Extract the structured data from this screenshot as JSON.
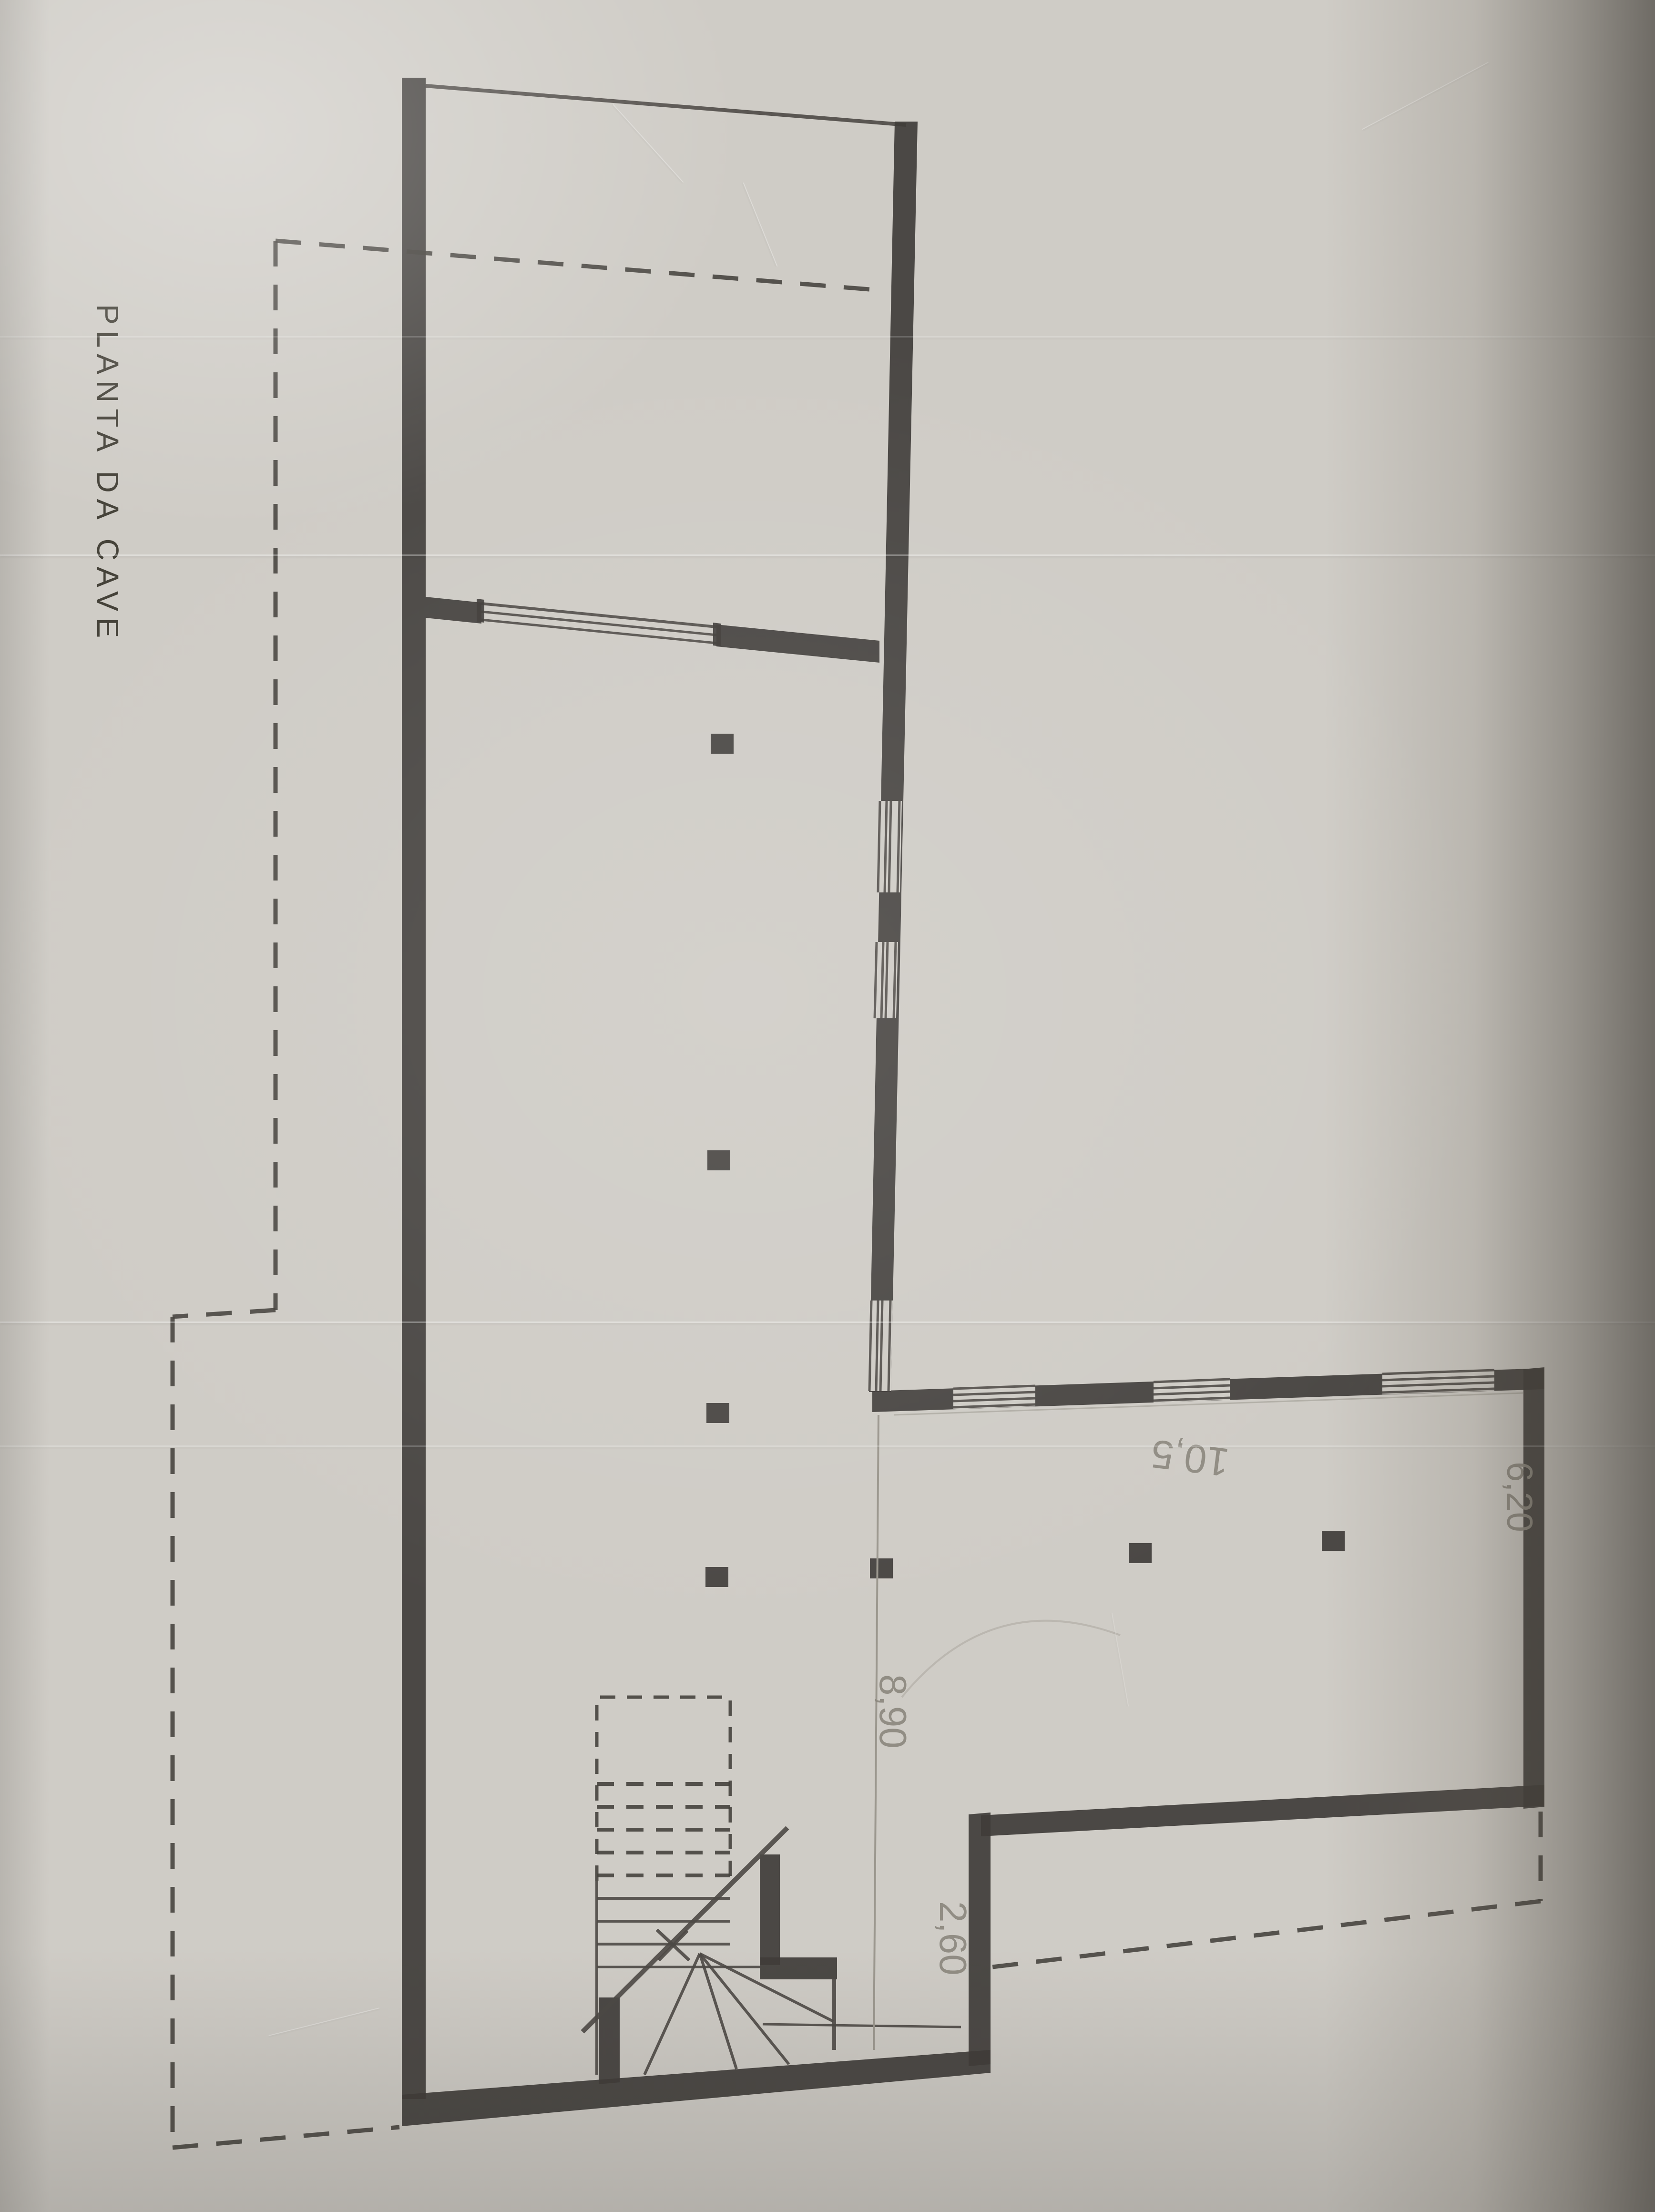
{
  "title": {
    "text": "PLANTA DA CAVE"
  },
  "dimensions": {
    "hall_width": {
      "text": "10,5"
    },
    "hall_depth": {
      "text": "6,20"
    },
    "wing_length": {
      "text": "8,90"
    },
    "passage_width": {
      "text": "2,60"
    }
  }
}
